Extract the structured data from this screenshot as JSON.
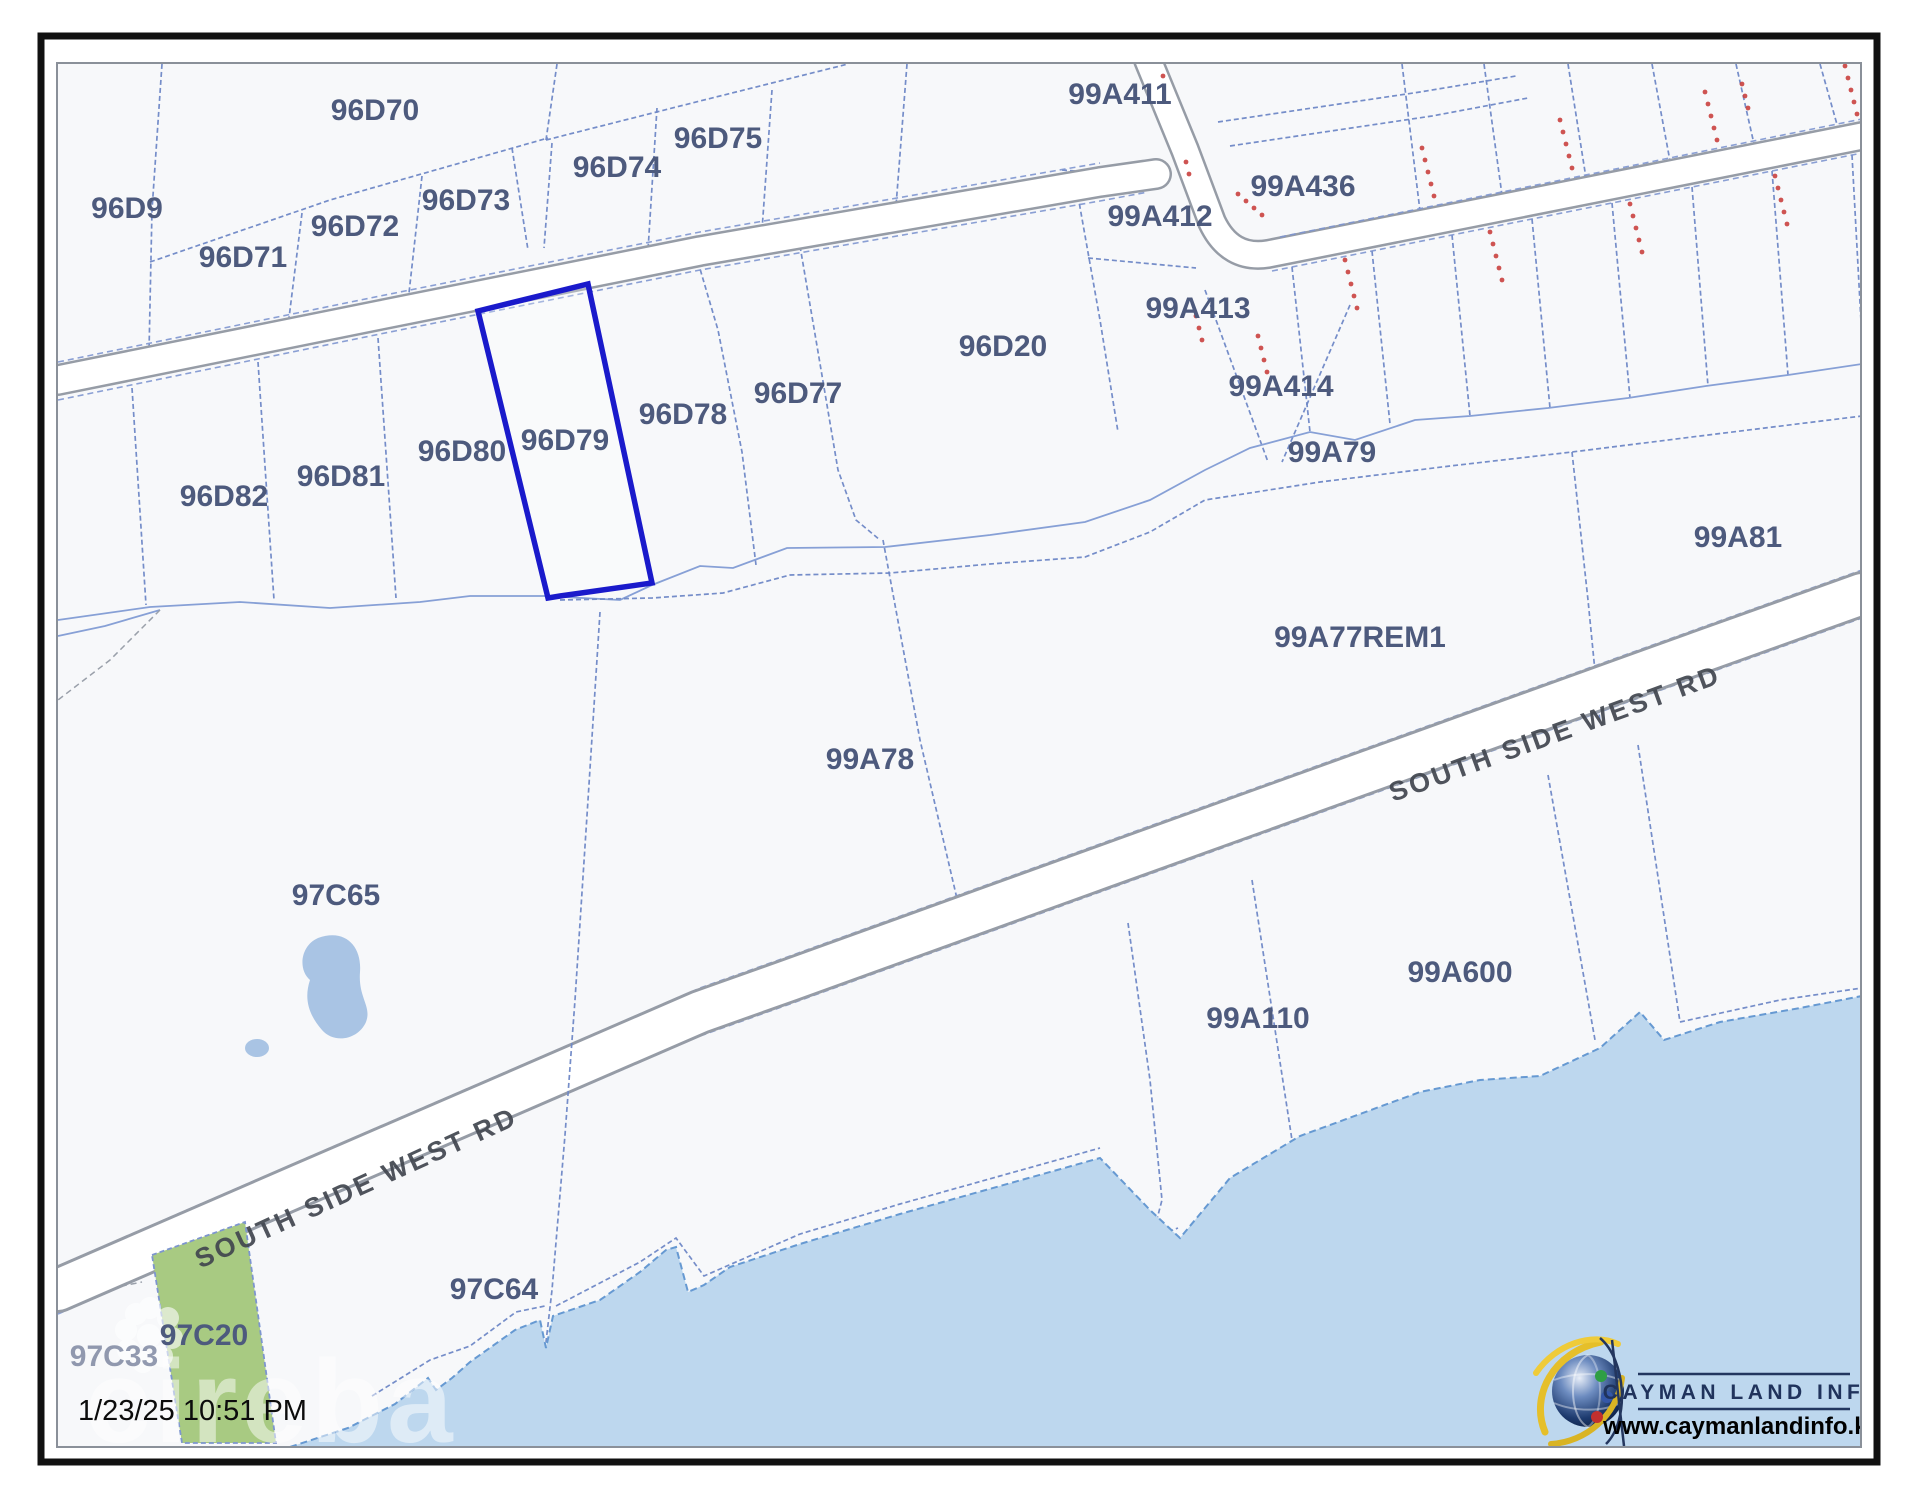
{
  "map": {
    "title": "Cadastral parcel map",
    "highlighted_parcel": "96D79",
    "road_label": "SOUTH SIDE WEST RD",
    "timestamp": "1/23/25 10:51 PM",
    "watermark_text": "cireba",
    "parcels": [
      {
        "id": "96D9",
        "x": 127,
        "y": 218
      },
      {
        "id": "96D70",
        "x": 375,
        "y": 120
      },
      {
        "id": "96D71",
        "x": 243,
        "y": 267
      },
      {
        "id": "96D72",
        "x": 355,
        "y": 236
      },
      {
        "id": "96D73",
        "x": 466,
        "y": 210
      },
      {
        "id": "96D74",
        "x": 617,
        "y": 177
      },
      {
        "id": "96D75",
        "x": 718,
        "y": 148
      },
      {
        "id": "99A411",
        "x": 1120,
        "y": 104
      },
      {
        "id": "99A412",
        "x": 1160,
        "y": 226
      },
      {
        "id": "99A436",
        "x": 1303,
        "y": 196
      },
      {
        "id": "99A413",
        "x": 1198,
        "y": 318
      },
      {
        "id": "99A414",
        "x": 1281,
        "y": 396
      },
      {
        "id": "96D20",
        "x": 1003,
        "y": 356
      },
      {
        "id": "96D77",
        "x": 798,
        "y": 403
      },
      {
        "id": "96D78",
        "x": 683,
        "y": 424
      },
      {
        "id": "96D79",
        "x": 565,
        "y": 450
      },
      {
        "id": "96D80",
        "x": 462,
        "y": 461
      },
      {
        "id": "96D81",
        "x": 341,
        "y": 486
      },
      {
        "id": "96D82",
        "x": 224,
        "y": 506
      },
      {
        "id": "99A79",
        "x": 1332,
        "y": 462
      },
      {
        "id": "99A81",
        "x": 1738,
        "y": 547
      },
      {
        "id": "99A77REM1",
        "x": 1360,
        "y": 647
      },
      {
        "id": "99A78",
        "x": 870,
        "y": 769
      },
      {
        "id": "97C65",
        "x": 336,
        "y": 905
      },
      {
        "id": "99A110",
        "x": 1258,
        "y": 1028
      },
      {
        "id": "99A600",
        "x": 1460,
        "y": 982
      },
      {
        "id": "97C64",
        "x": 494,
        "y": 1299
      },
      {
        "id": "97C20",
        "x": 204,
        "y": 1345
      },
      {
        "id": "97C33",
        "x": 114,
        "y": 1366,
        "faded": true
      }
    ],
    "colors": {
      "highlight_outline": "#1a1acb",
      "parcel_line": "#6e87c6",
      "water_fill": "#bdd7ee",
      "water_edge": "#6699d2",
      "green_parcel_fill": "#a8ca82",
      "survey_marks_red": "#c9403e",
      "map_background": "#f7f8fa",
      "label_blue": "#4d5a7d"
    }
  },
  "branding": {
    "logo_title": "CAYMAN LAND INFO",
    "logo_url": "www.caymanlandinfo.ky",
    "logo_icon": "globe-icon"
  }
}
